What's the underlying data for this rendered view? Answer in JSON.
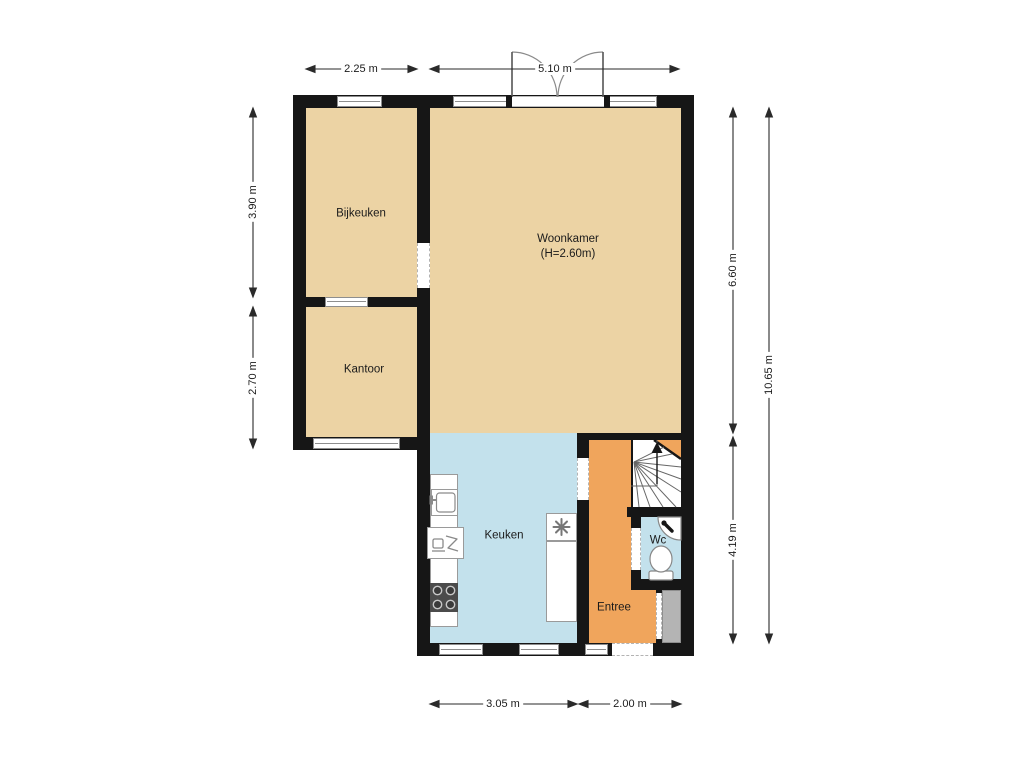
{
  "floorplan": {
    "rooms": {
      "bijkeuken": {
        "name": "Bijkeuken"
      },
      "woonkamer": {
        "name": "Woonkamer",
        "height_note": "(H=2.60m)"
      },
      "kantoor": {
        "name": "Kantoor"
      },
      "keuken": {
        "name": "Keuken"
      },
      "entree": {
        "name": "Entree"
      },
      "wc": {
        "name": "Wc"
      }
    },
    "dimensions": {
      "top_left": "2.25 m",
      "top_right": "5.10 m",
      "left_upper": "3.90 m",
      "left_lower": "2.70 m",
      "right_upper": "6.60 m",
      "right_lower": "4.19 m",
      "right_total": "10.65 m",
      "bottom_left": "3.05 m",
      "bottom_right": "2.00 m"
    },
    "colors": {
      "wall": "#161616",
      "room_tan": "#ecd3a4",
      "room_blue": "#c3e1ec",
      "room_orange": "#f0a55c",
      "closet_gray": "#b4b4b4"
    },
    "icons": {
      "staircase": "winder-stairs-up-arrow",
      "toilet": "toilet",
      "corner_sink": "corner-washbasin-with-tap",
      "kitchen_sink": "sink-with-tap",
      "dishwasher": "dishwasher",
      "stove": "four-burner-cooktop",
      "ventilation": "mechanical-fan-symbol",
      "french_doors": "double-garden-doors-swing"
    }
  }
}
